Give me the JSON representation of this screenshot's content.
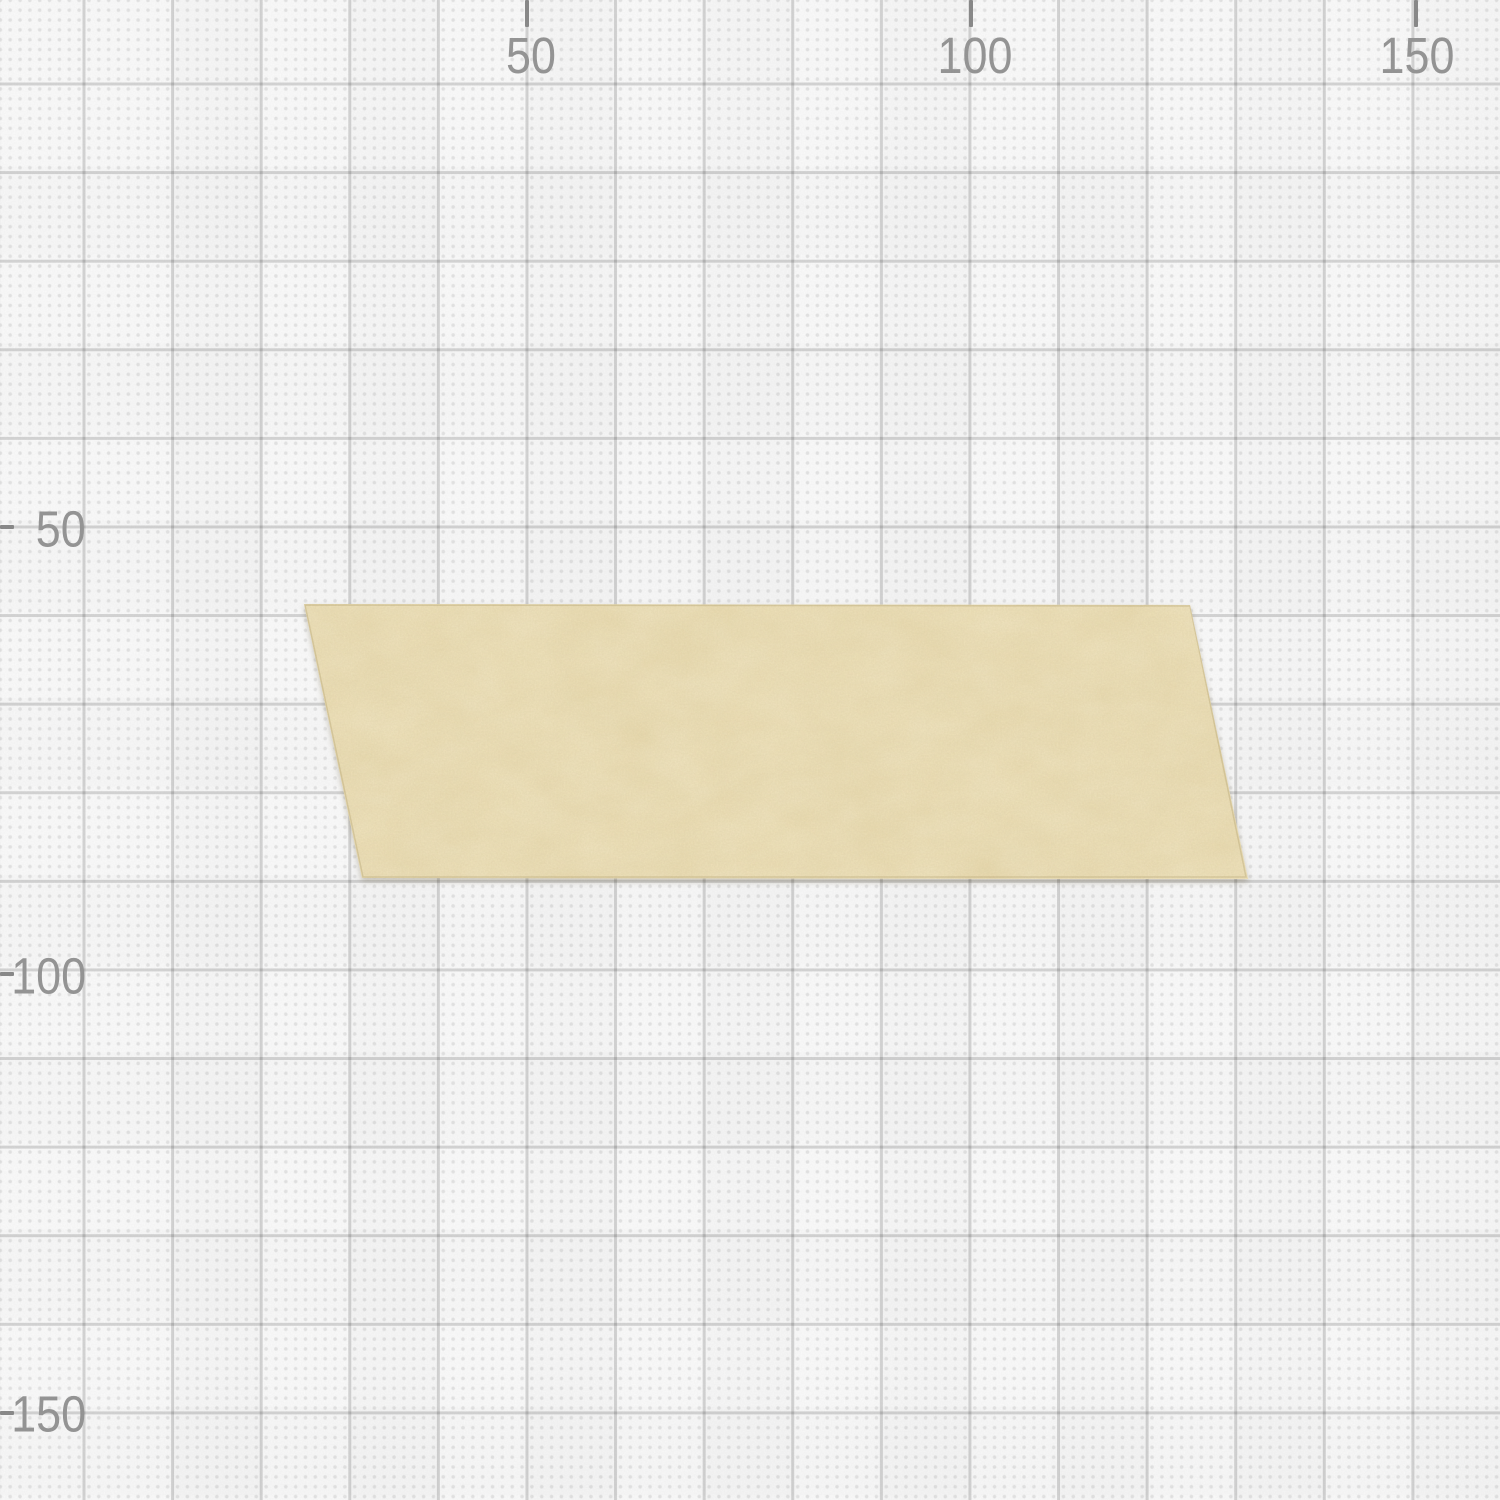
{
  "canvas": {
    "type": "graph-paper-canvas",
    "background_color": "#fcfcfc",
    "grid": {
      "major_line_color": "#d6d6d6",
      "major_cell_px": 88.6,
      "units_per_major_cell": 10,
      "dot_color": "#e6e6e6",
      "dots_per_major_cell": 9
    },
    "rulers": {
      "tick_color": "#8a8a8a",
      "label_color": "#969696",
      "top": [
        {
          "label": "50",
          "x_px": 527
        },
        {
          "label": "100",
          "x_px": 971
        },
        {
          "label": "150",
          "x_px": 1416
        }
      ],
      "left": [
        {
          "label": "50",
          "y_px": 527
        },
        {
          "label": "100",
          "y_px": 971
        },
        {
          "label": "150",
          "y_px": 1416
        }
      ]
    }
  },
  "objects": [
    {
      "name": "tape-strip",
      "kind": "washi-tape",
      "fill_color": "#f2e5bd",
      "corners_px": [
        [
          304,
          604
        ],
        [
          1190,
          605
        ],
        [
          1248,
          879
        ],
        [
          362,
          878
        ]
      ]
    }
  ]
}
